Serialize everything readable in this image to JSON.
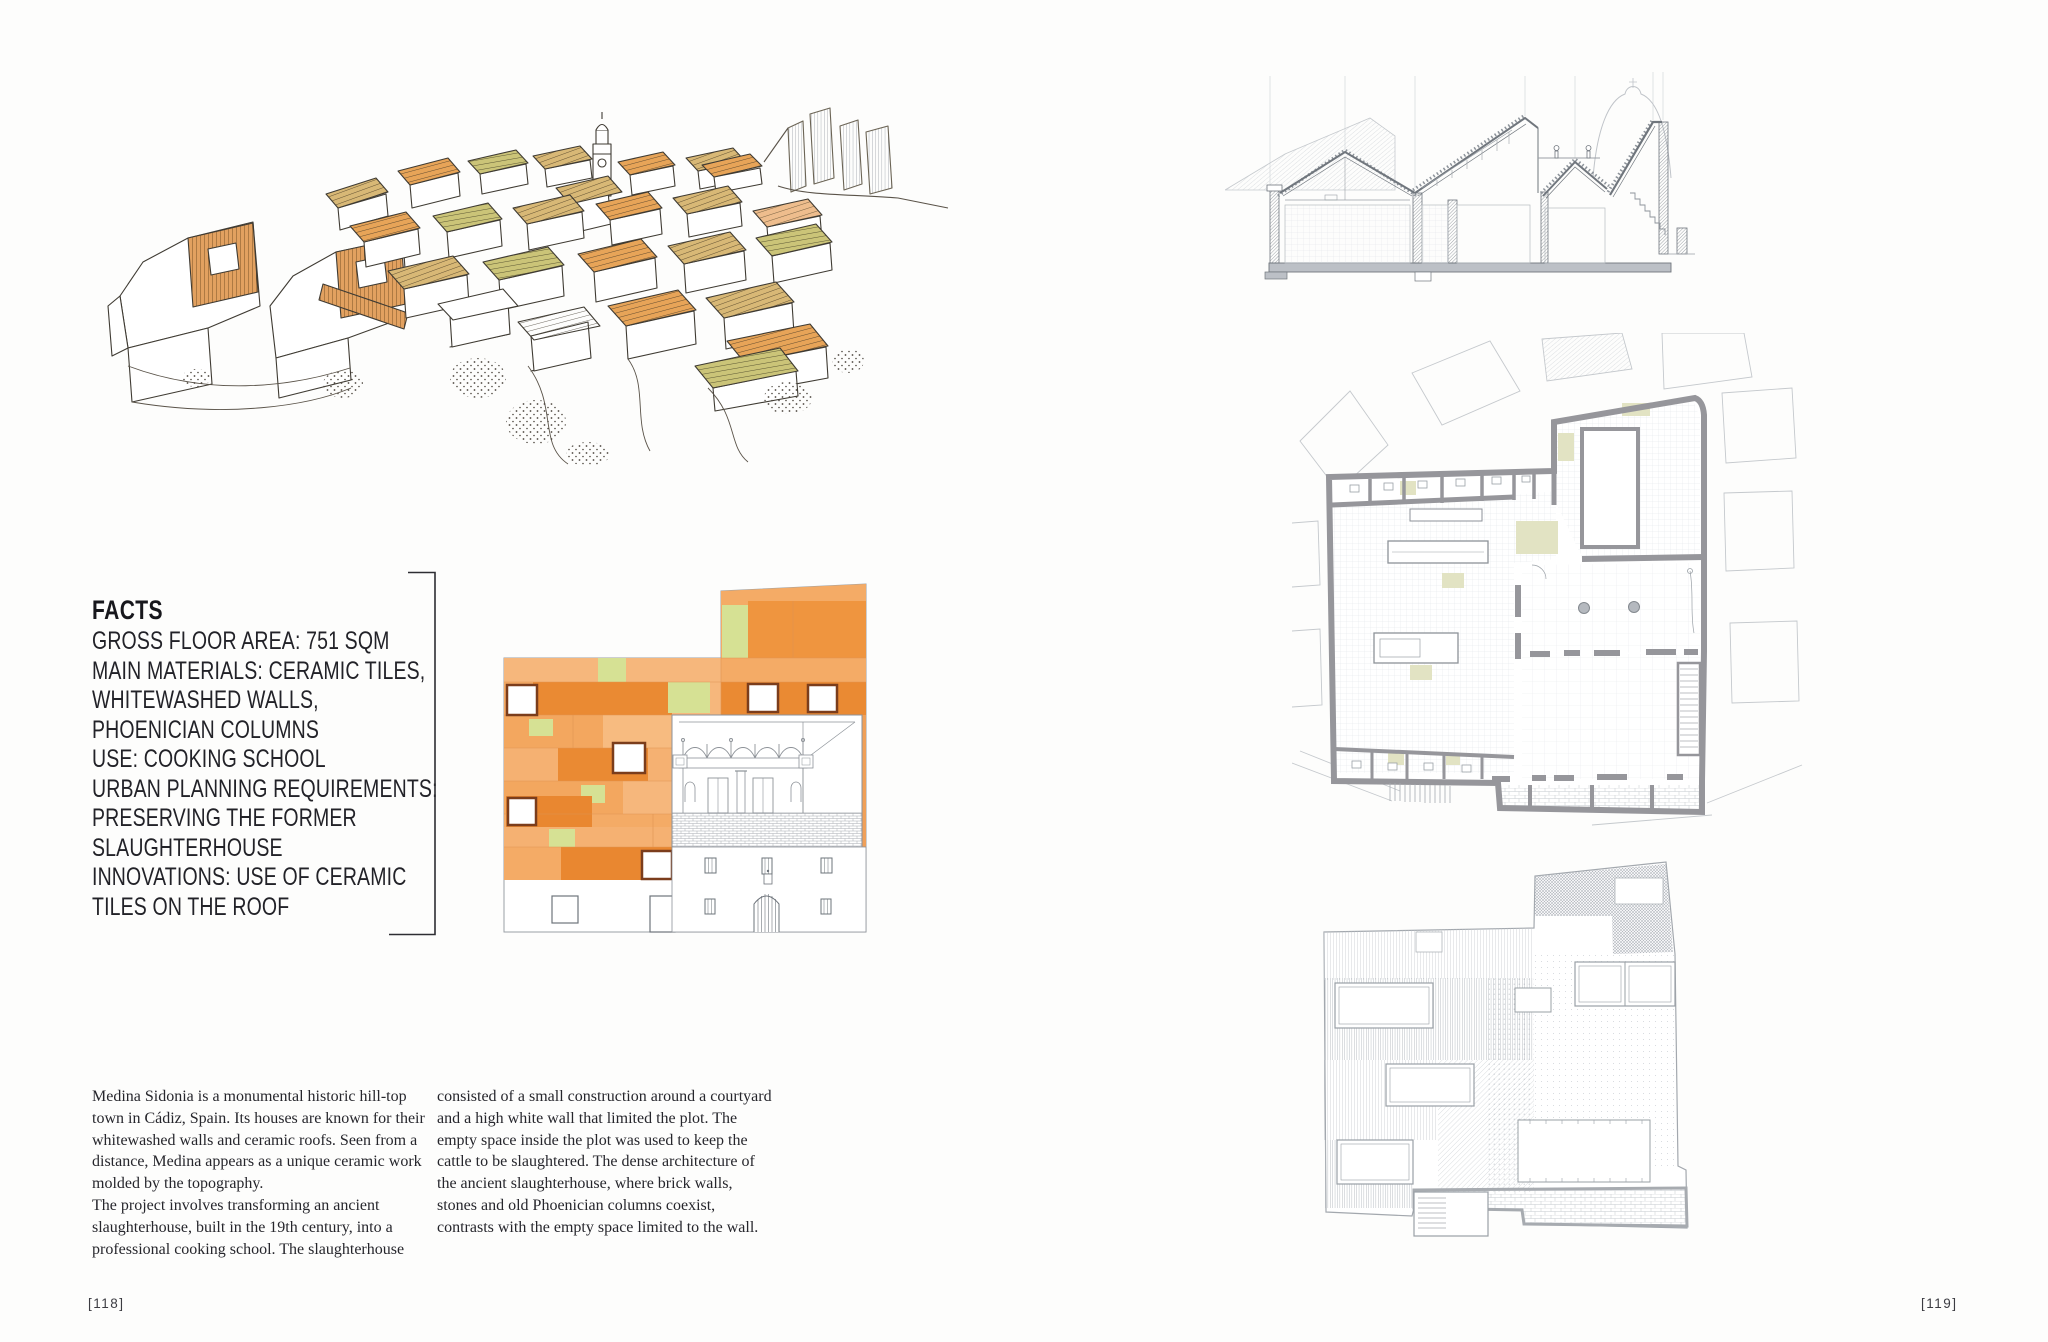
{
  "document": {
    "type": "book-spread",
    "left_page": {
      "number": "[118]"
    },
    "right_page": {
      "number": "[119]"
    }
  },
  "facts": {
    "title": "FACTS",
    "lines": [
      "GROSS FLOOR AREA: 751 SQM",
      "MAIN MATERIALS: CERAMIC TILES,",
      "WHITEWASHED WALLS,",
      "PHOENICIAN COLUMNS",
      "USE: COOKING SCHOOL",
      "URBAN PLANNING REQUIREMENTS:",
      "PRESERVING THE FORMER",
      "SLAUGHTERHOUSE",
      "INNOVATIONS: USE OF CERAMIC",
      "TILES ON THE ROOF"
    ]
  },
  "body": {
    "column_1_paragraphs": [
      "Medina Sidonia is a monumental historic hill-top town in Cádiz, Spain. Its houses are known for their whitewashed walls and ceramic roofs. Seen from a distance, Medina appears as a unique ceramic work molded by the topography.",
      "The project involves transforming an ancient slaughterhouse, built in the 19th century, into a professional cooking school. The slaughterhouse"
    ],
    "column_2_paragraphs": [
      "consisted of a small construction around a courtyard and a high white wall that limited the plot. The empty space inside the plot was used to keep the cattle to be slaughtered. The dense architecture of the ancient slaughterhouse, where brick walls, stones and old Phoenician columns coexist, contrasts with the empty space limited to the wall."
    ]
  },
  "figures": {
    "town_sketch": "hand-drawn sketch of Medina Sidonia hilltop town with ceramic roofs",
    "elevation": "colored elevation of ceramic tile facade with preserved slaughterhouse front",
    "section": "building cross section",
    "floor_plan": "ground floor plan",
    "roof_plan": "roof plan with skylights"
  },
  "colors": {
    "tile_orange_light": "#f4ab66",
    "tile_orange_mid": "#ee9440",
    "tile_orange_dark": "#e88430",
    "tile_green": "#d6e194",
    "sketch_orange": "#e7a458",
    "sketch_tan": "#d8b876",
    "sketch_olive": "#cbc478",
    "plan_gray": "#96969b",
    "ink": "#1e1e24"
  }
}
